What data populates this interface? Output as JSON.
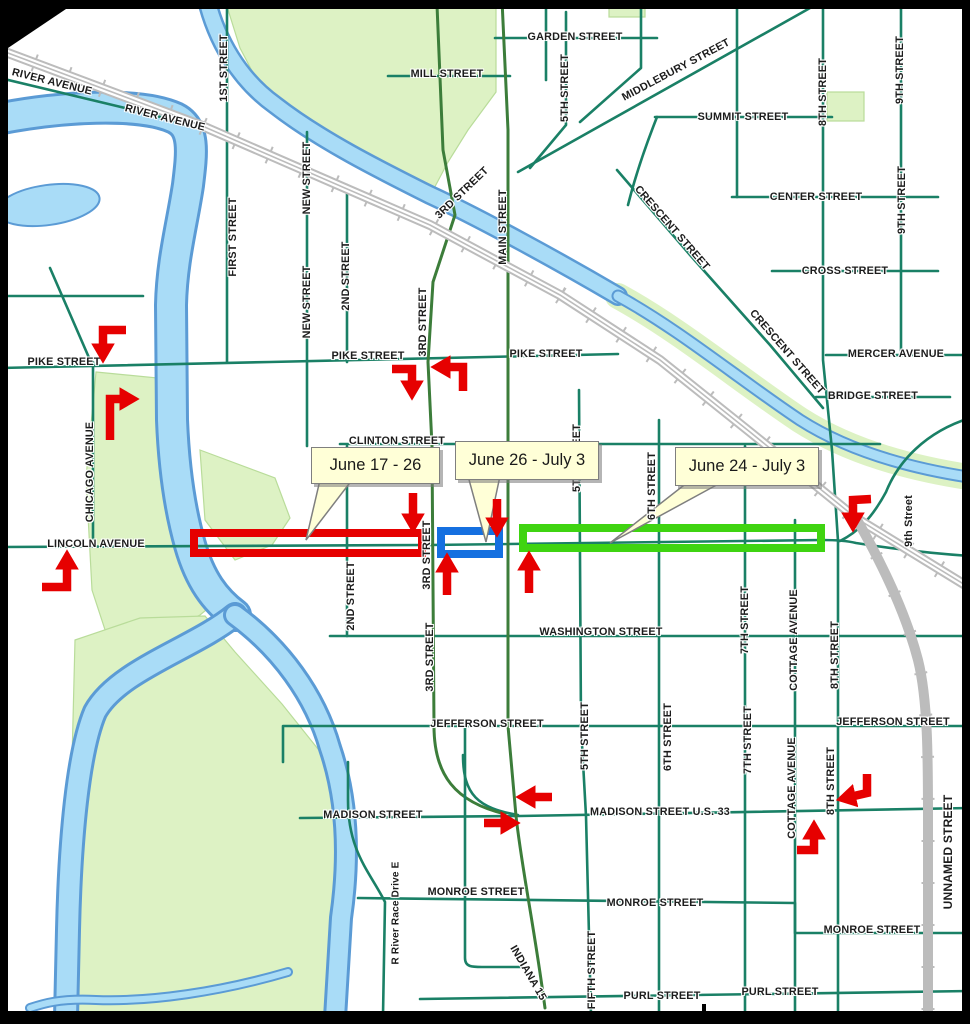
{
  "colors": {
    "road": "#1a8066",
    "road2": "#3c7d3a",
    "water": "#a9dcf7",
    "water_edge": "#5b9bd5",
    "park": "#ddf2c4",
    "park_edge": "#b9dc9a",
    "rail": "#bcbcbc",
    "arrow": "#e60000",
    "callout_bg": "#ffffd7",
    "callout_border": "#7f7f7f",
    "zone_red": "#e60000",
    "zone_blue": "#1570e0",
    "zone_green": "#3fd411"
  },
  "closure_zones": [
    {
      "id": "zone-red",
      "dates": "June 17 - 26",
      "color": "#e60000",
      "rect": {
        "x": 194,
        "y": 533,
        "w": 228,
        "h": 20
      }
    },
    {
      "id": "zone-blue",
      "dates": "June 26 - July 3",
      "color": "#1570e0",
      "rect": {
        "x": 441,
        "y": 531,
        "w": 58,
        "h": 23
      }
    },
    {
      "id": "zone-green",
      "dates": "June 24 - July 3",
      "color": "#3fd411",
      "rect": {
        "x": 523,
        "y": 528,
        "w": 298,
        "h": 20
      }
    }
  ],
  "callouts": [
    {
      "label": "June 17 - 26",
      "box": {
        "x": 311,
        "y": 447,
        "w": 127,
        "h": 35
      },
      "tail": [
        [
          320,
          480
        ],
        [
          352,
          480
        ],
        [
          306,
          540
        ]
      ]
    },
    {
      "label": "June 26 - July 3",
      "box": {
        "x": 455,
        "y": 441,
        "w": 142,
        "h": 37
      },
      "tail": [
        [
          468,
          476
        ],
        [
          500,
          476
        ],
        [
          486,
          542
        ]
      ]
    },
    {
      "label": "June 24 - July 3",
      "box": {
        "x": 675,
        "y": 447,
        "w": 142,
        "h": 37
      },
      "tail": [
        [
          688,
          482
        ],
        [
          722,
          482
        ],
        [
          610,
          543
        ]
      ]
    }
  ],
  "street_labels": [
    {
      "text": "RIVER AVENUE",
      "x": 52,
      "y": 82,
      "rot": 14
    },
    {
      "text": "RIVER AVENUE",
      "x": 165,
      "y": 118,
      "rot": 14
    },
    {
      "text": "1ST STREET",
      "x": 224,
      "y": 68,
      "rot": -90
    },
    {
      "text": "FIRST STREET",
      "x": 233,
      "y": 237,
      "rot": -90
    },
    {
      "text": "NEW STREET",
      "x": 307,
      "y": 178,
      "rot": -90
    },
    {
      "text": "NEW STREET",
      "x": 307,
      "y": 302,
      "rot": -90
    },
    {
      "text": "2ND STREET",
      "x": 346,
      "y": 276,
      "rot": -90
    },
    {
      "text": "3RD STREET",
      "x": 462,
      "y": 193,
      "rot": -44
    },
    {
      "text": "3RD STREET",
      "x": 423,
      "y": 322,
      "rot": -90
    },
    {
      "text": "MAIN STREET",
      "x": 503,
      "y": 227,
      "rot": -90
    },
    {
      "text": "5TH STREET",
      "x": 565,
      "y": 88,
      "rot": -90
    },
    {
      "text": "GARDEN STREET",
      "x": 575,
      "y": 37,
      "rot": 0
    },
    {
      "text": "MILL STREET",
      "x": 447,
      "y": 74,
      "rot": 0
    },
    {
      "text": "MIDDLEBURY STREET",
      "x": 676,
      "y": 70,
      "rot": -28
    },
    {
      "text": "SUMMIT STREET",
      "x": 743,
      "y": 117,
      "rot": 0
    },
    {
      "text": "8TH STREET",
      "x": 823,
      "y": 92,
      "rot": -90
    },
    {
      "text": "9TH STREET",
      "x": 900,
      "y": 70,
      "rot": -90
    },
    {
      "text": "9TH STREET",
      "x": 902,
      "y": 200,
      "rot": -90
    },
    {
      "text": "CENTER STREET",
      "x": 816,
      "y": 197,
      "rot": 0
    },
    {
      "text": "CROSS STREET",
      "x": 845,
      "y": 271,
      "rot": 0
    },
    {
      "text": "CRESCENT STREET",
      "x": 672,
      "y": 228,
      "rot": 49
    },
    {
      "text": "CRESCENT STREET",
      "x": 787,
      "y": 352,
      "rot": 49
    },
    {
      "text": "MERCER AVENUE",
      "x": 896,
      "y": 354,
      "rot": 0
    },
    {
      "text": "BRIDGE STREET",
      "x": 873,
      "y": 396,
      "rot": 0
    },
    {
      "text": "PIKE STREET",
      "x": 64,
      "y": 362,
      "rot": 0
    },
    {
      "text": "PIKE STREET",
      "x": 368,
      "y": 356,
      "rot": 0
    },
    {
      "text": "PIKE STREET",
      "x": 546,
      "y": 354,
      "rot": 0
    },
    {
      "text": "CHICAGO AVENUE",
      "x": 90,
      "y": 472,
      "rot": -90
    },
    {
      "text": "CLINTON STREET",
      "x": 397,
      "y": 441,
      "rot": 0
    },
    {
      "text": "LINCOLN AVENUE",
      "x": 96,
      "y": 544,
      "rot": 0
    },
    {
      "text": "2ND STREET",
      "x": 351,
      "y": 596,
      "rot": -90
    },
    {
      "text": "3RD STREET",
      "x": 427,
      "y": 555,
      "rot": -90
    },
    {
      "text": "3RD STREET",
      "x": 430,
      "y": 657,
      "rot": -90
    },
    {
      "text": "5TH STREET",
      "x": 577,
      "y": 458,
      "rot": -90
    },
    {
      "text": "6TH STREET",
      "x": 652,
      "y": 486,
      "rot": -90
    },
    {
      "text": "9th Street",
      "x": 909,
      "y": 521,
      "rot": -90
    },
    {
      "text": "WASHINGTON STREET",
      "x": 601,
      "y": 632,
      "rot": 0
    },
    {
      "text": "5TH STREET",
      "x": 585,
      "y": 736,
      "rot": -90
    },
    {
      "text": "6TH STREET",
      "x": 668,
      "y": 737,
      "rot": -90
    },
    {
      "text": "7TH STREET",
      "x": 745,
      "y": 620,
      "rot": -90
    },
    {
      "text": "7TH STREET",
      "x": 748,
      "y": 740,
      "rot": -90
    },
    {
      "text": "JEFFERSON STREET",
      "x": 487,
      "y": 724,
      "rot": 0
    },
    {
      "text": "JEFFERSON STREET",
      "x": 893,
      "y": 722,
      "rot": 0
    },
    {
      "text": "COTTAGE AVENUE",
      "x": 794,
      "y": 640,
      "rot": -90
    },
    {
      "text": "COTTAGE AVENUE",
      "x": 792,
      "y": 788,
      "rot": -90
    },
    {
      "text": "8TH STREET",
      "x": 835,
      "y": 655,
      "rot": -90
    },
    {
      "text": "8TH STREET",
      "x": 831,
      "y": 781,
      "rot": -90
    },
    {
      "text": "MADISON STREET",
      "x": 373,
      "y": 815,
      "rot": 0
    },
    {
      "text": "MADISON STREET U.S. 33",
      "x": 660,
      "y": 812,
      "rot": 0
    },
    {
      "text": "MONROE STREET",
      "x": 476,
      "y": 892,
      "rot": 0
    },
    {
      "text": "MONROE STREET",
      "x": 655,
      "y": 903,
      "rot": 0
    },
    {
      "text": "MONROE STREET",
      "x": 872,
      "y": 930,
      "rot": 0
    },
    {
      "text": "R River Race Drive E",
      "x": 396,
      "y": 913,
      "rot": -90,
      "size": 10
    },
    {
      "text": "INDIANA 15",
      "x": 528,
      "y": 973,
      "rot": 60
    },
    {
      "text": "FIFTH STREET",
      "x": 592,
      "y": 970,
      "rot": -90
    },
    {
      "text": "PURL STREET",
      "x": 662,
      "y": 996,
      "rot": 0
    },
    {
      "text": "PURL STREET",
      "x": 780,
      "y": 992,
      "rot": 0
    },
    {
      "text": "UNNAMED STREET",
      "x": 948,
      "y": 852,
      "rot": -90,
      "size": 12
    }
  ]
}
